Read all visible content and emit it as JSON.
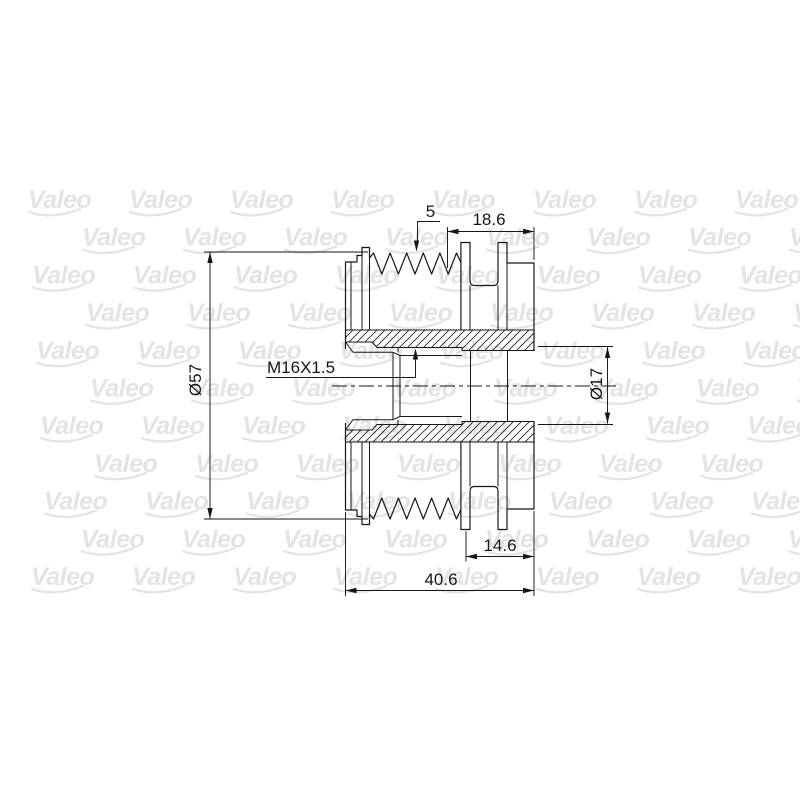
{
  "page": {
    "background_color": "#ffffff",
    "line_color": "#161616"
  },
  "watermark": {
    "text": "Valeo",
    "color": "#e4e4e4"
  },
  "drawing": {
    "type": "technical-drawing",
    "subject": "alternator freewheel pulley cross-section",
    "dimensions": {
      "rib_count": "5",
      "front_section_width": "18.6",
      "outer_diameter": "Ø57",
      "thread_spec": "M16X1.5",
      "bore_diameter": "Ø17",
      "hub_width": "14.6",
      "overall_width": "40.6"
    }
  }
}
